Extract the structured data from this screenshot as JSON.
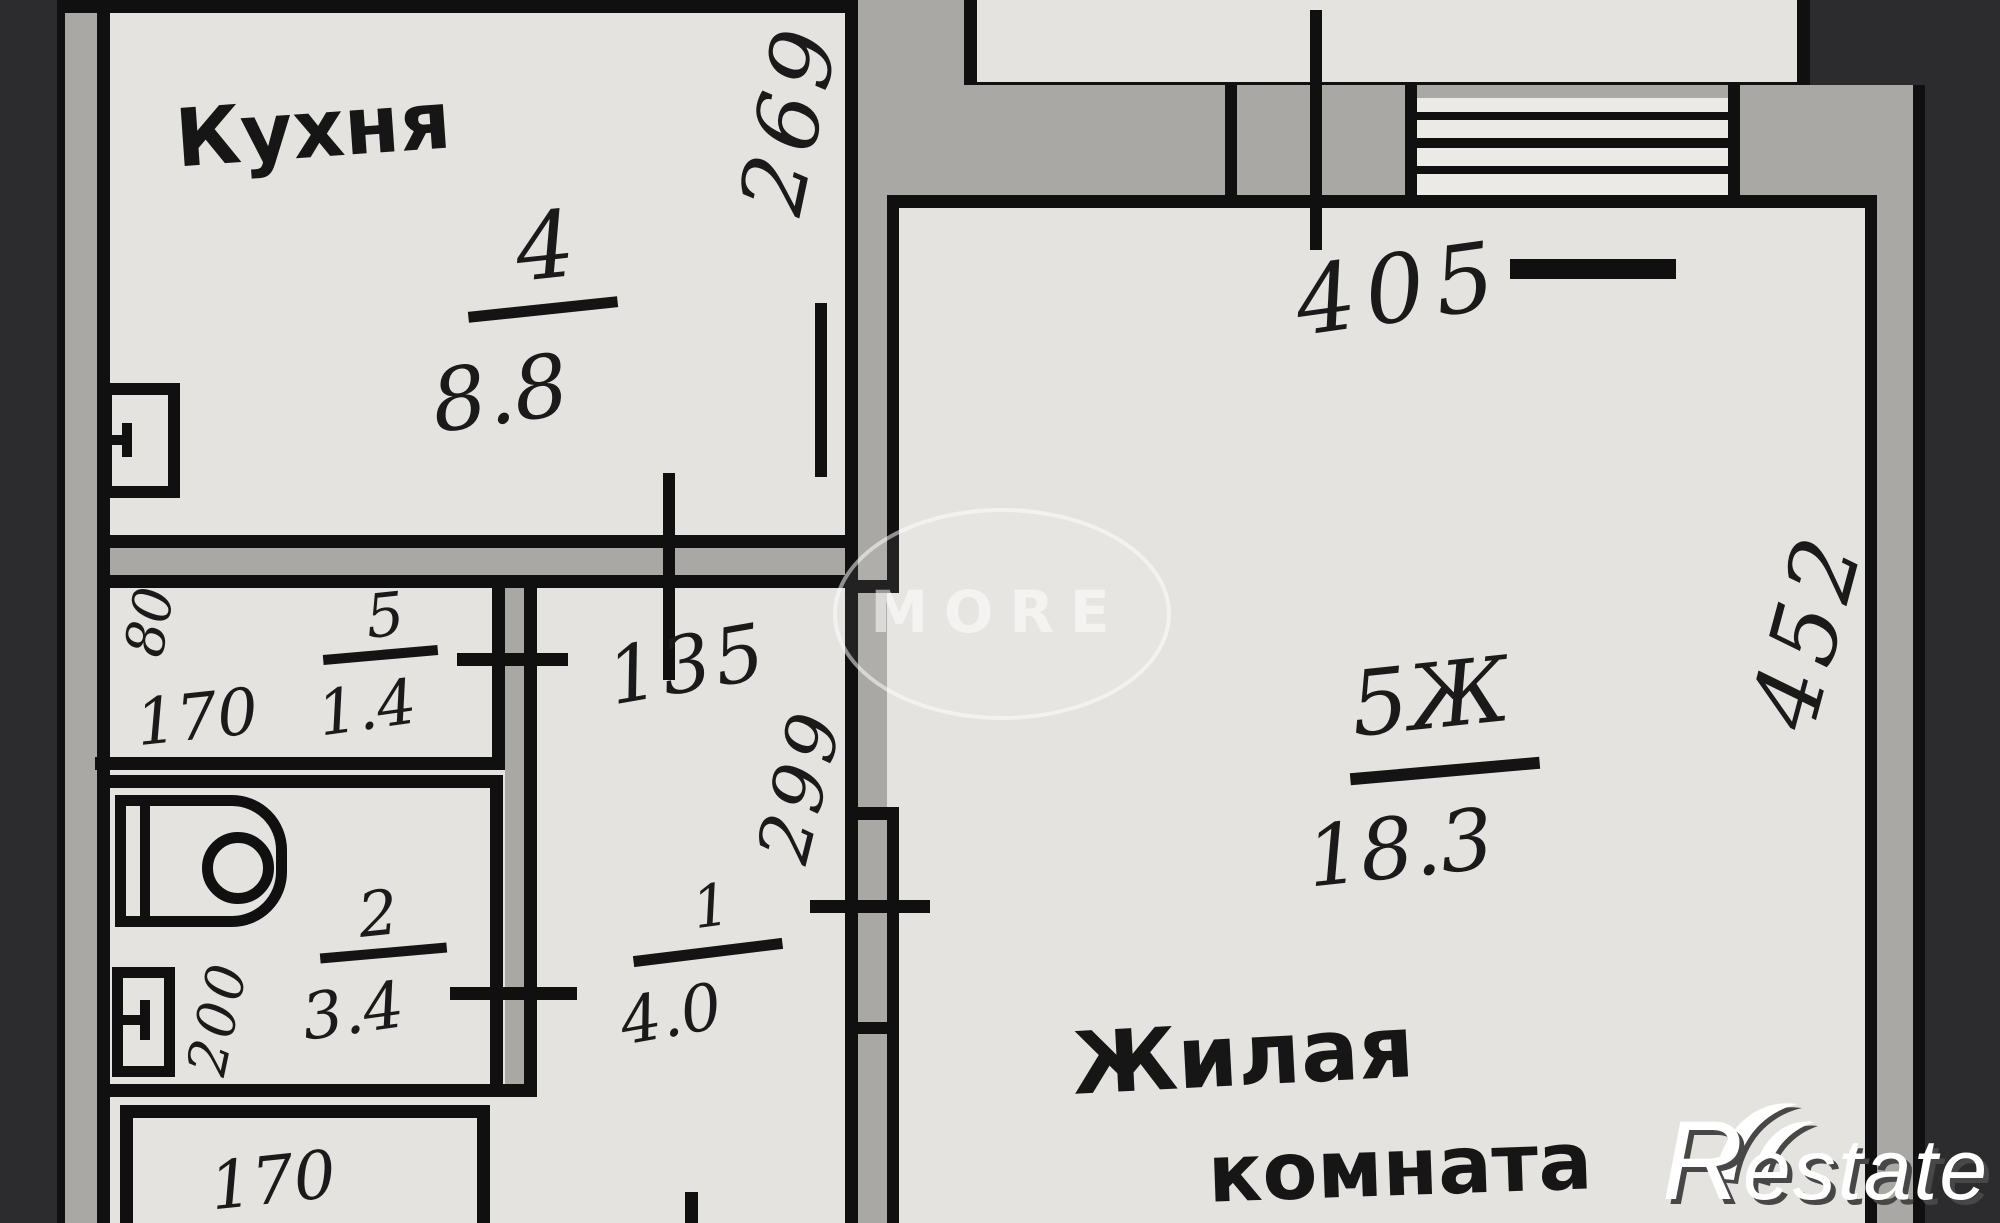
{
  "plan": {
    "rooms": {
      "kitchen": {
        "name": "Кухня",
        "number": "4",
        "area": "8.8"
      },
      "storage": {
        "number": "5",
        "area": "1.4"
      },
      "bathroom": {
        "number": "2",
        "area": "3.4"
      },
      "hall": {
        "number": "1",
        "area": "4.0"
      },
      "living": {
        "name_line1": "Жилая",
        "name_line2": "комната",
        "number": "5Ж",
        "area": "18.3"
      }
    },
    "dimensions": {
      "kitchen_wall": "269",
      "top_width": "405",
      "living_height": "452",
      "door_width": "135",
      "hall_height": "299",
      "storage_side": "80",
      "storage_width": "170",
      "bathroom_side": "200",
      "lower_box_width": "170"
    }
  },
  "watermark": {
    "text": "MORE"
  },
  "logo": {
    "initial": "R",
    "rest": "estate"
  }
}
